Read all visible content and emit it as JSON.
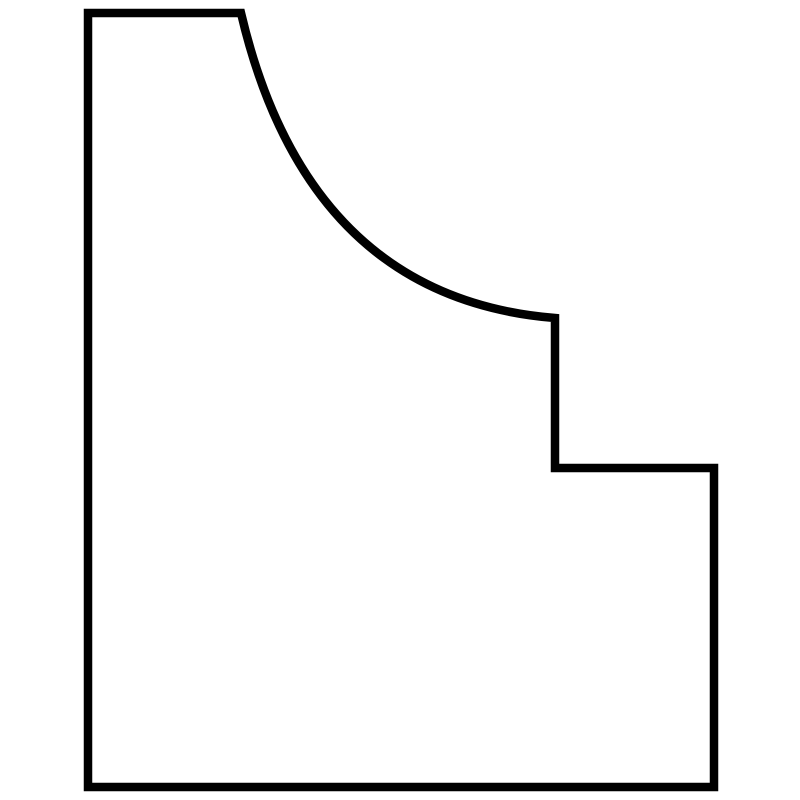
{
  "canvas": {
    "width": 800,
    "height": 800,
    "background_color": "#ffffff"
  },
  "shape": {
    "description": "closed-profile-outline-with-concave-cove-curve-and-step",
    "stroke_color": "#000000",
    "stroke_width": 8.5,
    "fill": "none",
    "path_d": "M 88 13 L 241 13 Q 308 298 555 318 L 555 468 L 714 468 L 714 787 L 88 787 Z",
    "vertices": [
      {
        "x": 88,
        "y": 13,
        "type": "corner-top-left"
      },
      {
        "x": 241,
        "y": 13,
        "type": "corner-top-edge-end-curve-start"
      },
      {
        "x": 555,
        "y": 318,
        "type": "curve-end-corner"
      },
      {
        "x": 555,
        "y": 468,
        "type": "step-inner-corner"
      },
      {
        "x": 714,
        "y": 468,
        "type": "step-outer-corner"
      },
      {
        "x": 714,
        "y": 787,
        "type": "corner-bottom-right"
      },
      {
        "x": 88,
        "y": 787,
        "type": "corner-bottom-left"
      }
    ],
    "curve": {
      "type": "quadratic-bezier",
      "start": {
        "x": 241,
        "y": 13
      },
      "control": {
        "x": 308,
        "y": 298
      },
      "end": {
        "x": 555,
        "y": 318
      }
    }
  }
}
